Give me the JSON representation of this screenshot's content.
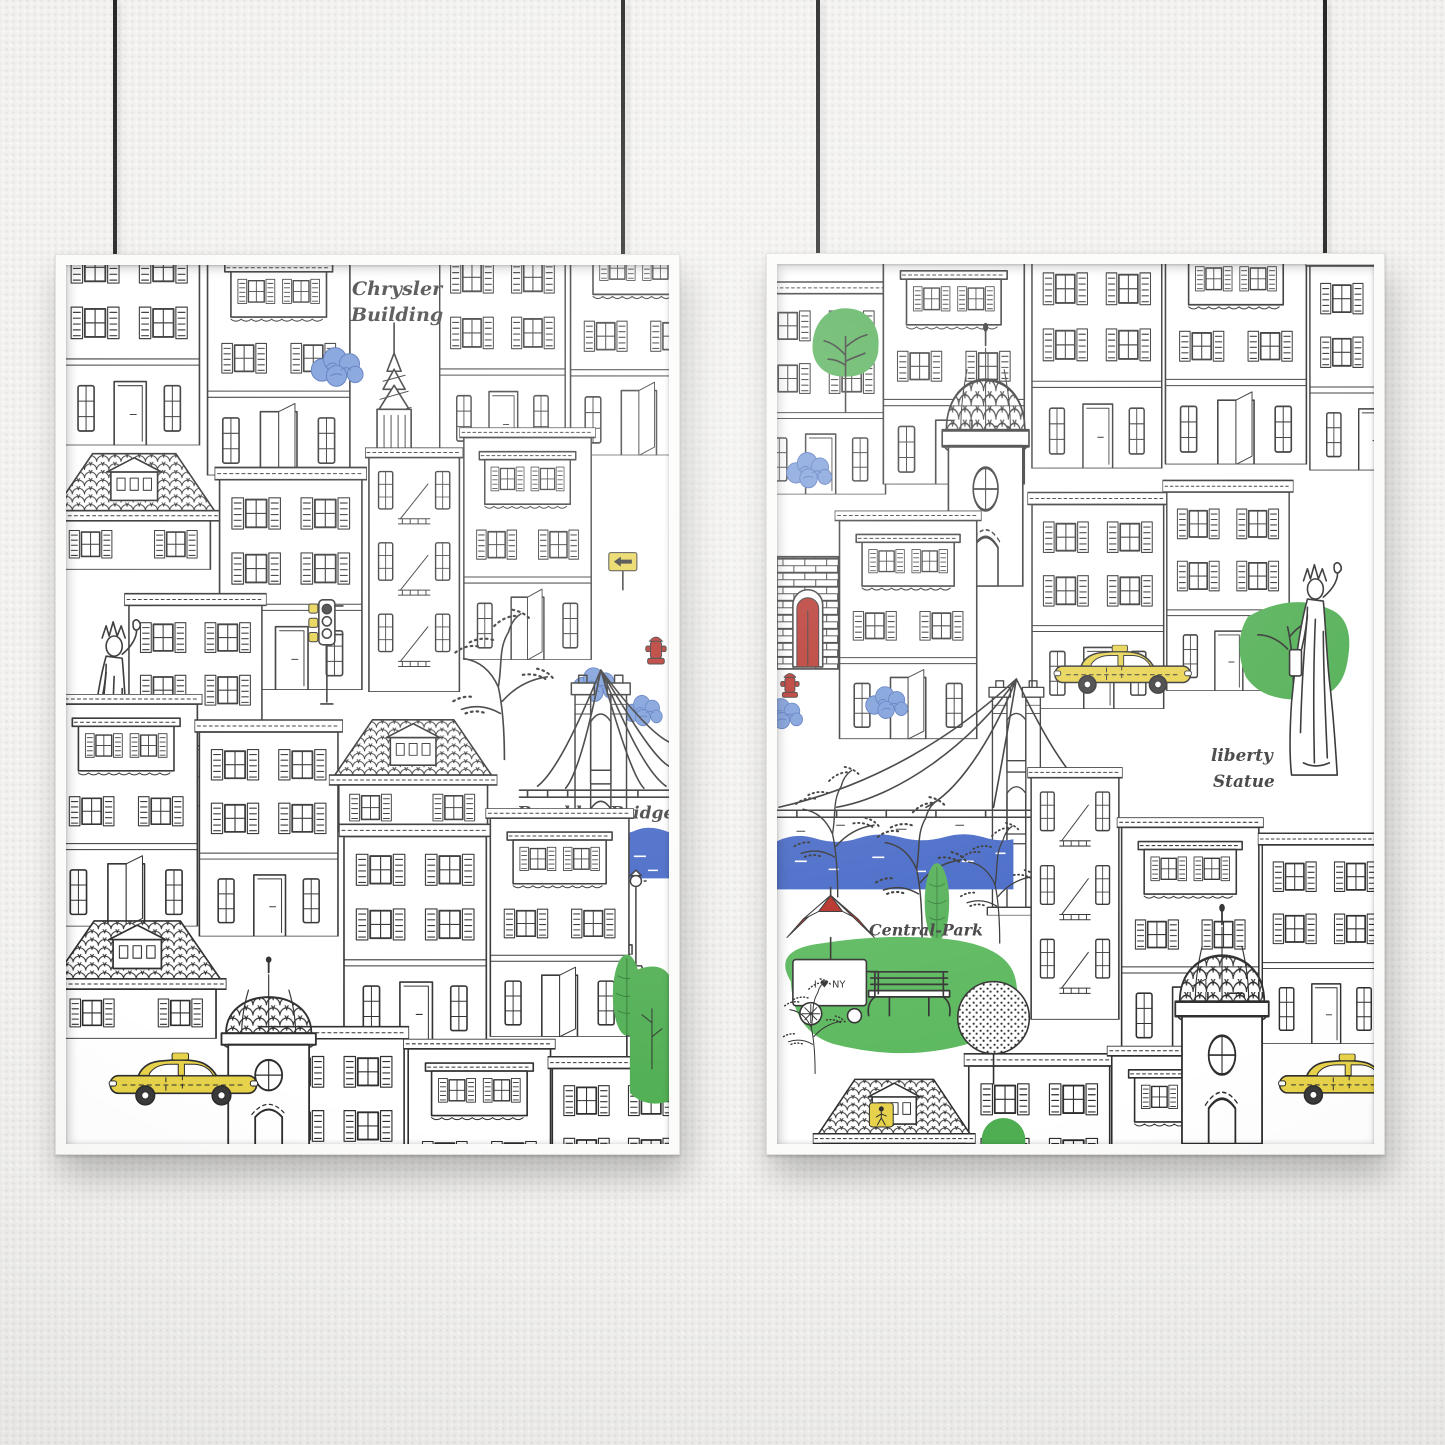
{
  "colors": {
    "wall": "#f1f0ee",
    "cord": "#1e1e1e",
    "frame": "#fbfbfa",
    "frame_edge": "#e0dfdd",
    "paper": "#ffffff",
    "ink": "#2d2d2d",
    "script_ink": "#3c3c3c",
    "taxi_yellow": "#e7d24b",
    "tree_green": "#4fae52",
    "lawn_green": "#58b75a",
    "river_blue": "#3f63c5",
    "cloud_blue": "#7497d8",
    "cloud_ink": "#4a6cb8",
    "accent_red": "#b2271f"
  },
  "left_poster": {
    "labels": {
      "chrysler_line1": "Chrysler",
      "chrysler_line2": "Building",
      "brooklyn_bridge": "Brooklyn Bridge",
      "edge_fragment_top": "y",
      "edge_fragment_bottom": "e"
    }
  },
  "right_poster": {
    "labels": {
      "liberty_line1": "liberty",
      "liberty_line2": "Statue",
      "central_park": "Central-Park",
      "cart_sign": "I ♥ NY"
    }
  }
}
